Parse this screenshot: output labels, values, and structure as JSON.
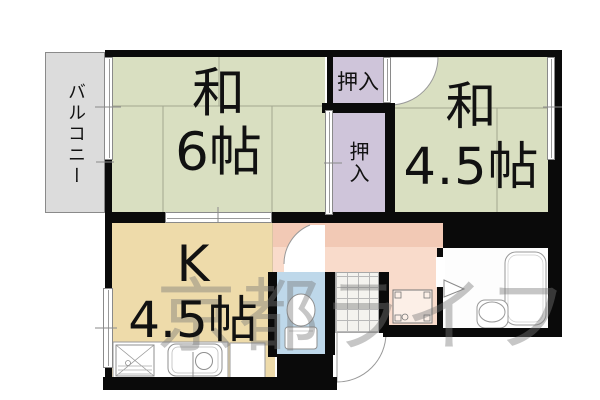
{
  "labels": {
    "balcony": "バルコニー",
    "room6_line1": "和",
    "room6_line2": "6帖",
    "room45_line1": "和",
    "room45_line2": "4.5帖",
    "kitchen_line1": "K",
    "kitchen_line2": "4.5帖",
    "closet_top": "押入",
    "closet_bottom": "押入",
    "watermark": "京都ライフ"
  },
  "colors": {
    "tatami": "#d9dfc1",
    "closet": "#cfc5da",
    "kitchen": "#eedbaa",
    "hallway_dark": "#f2c9b5",
    "hallway_light": "#f9dbcb",
    "toilet": "#bed8ea",
    "balcony": "#dcdcdc",
    "wall": "#0a0a0a",
    "fixture_outline": "#8f8f8f",
    "tatami_line": "#a3a78f",
    "watermark_gray": "#787878"
  }
}
